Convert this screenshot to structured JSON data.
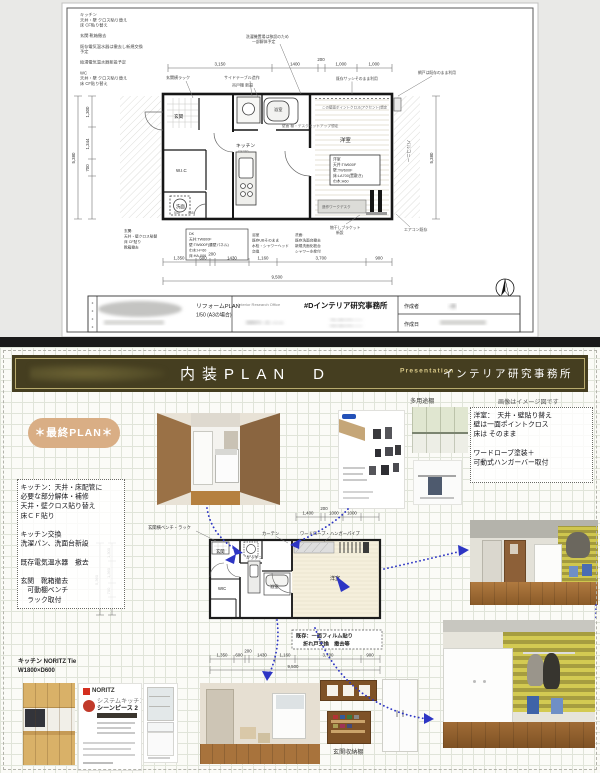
{
  "colors": {
    "banner_olive": "#453e20",
    "badge_tan": "#d9ae85",
    "arrow_blue": "#2d35c4",
    "gold_line": "#cdbe7d"
  },
  "top_sheet": {
    "notes_left": [
      "キッチン",
      "天井・壁 クロス貼り替え",
      "床 CF貼り替え",
      "",
      "玄関 靴箱撤去",
      "",
      "既存電気温水器は撤去し新規交換",
      "予定",
      "",
      "給湯電気温水器新設予定",
      "",
      "WC",
      "天井・壁 クロス貼り替え",
      "床 CF貼り替え"
    ],
    "leaders": {
      "rack": "玄関横ラック",
      "side_table": "サイドテーブル造作",
      "hang_shelf": "吊戸棚 新設",
      "top_note1": "洗濯機置場は移設のため",
      "top_note2": "一部解体予定",
      "sash": "既存サッシそのまま利用",
      "amido": "網戸は既存のまま利用",
      "accent": "この壁面ポイントクロス(アクセント)想定",
      "desk_note": "壁面 棚・デスクセットアップ想定",
      "aircon": "エアコン既存",
      "bracket1": "物干しブラケット",
      "bracket2": "新設",
      "work_desk": "造作ワークデスク"
    },
    "rooms": {
      "entrance": "玄関",
      "wic": "W.I.C",
      "wash": "洗面",
      "kitchen": "キッチン",
      "kitchen_sub": "CK240",
      "bath": "浴室",
      "room": "洋室",
      "balcony": "バルコニー"
    },
    "room_box": [
      "洋室",
      "天井:TW600F",
      "壁:TW600F",
      "床:LA700(置敷き)",
      "巾木:H60"
    ],
    "dk_box": [
      "DK",
      "天井:TW600F",
      "壁:TW600F(腰壁パネル)",
      "巾木:H=60",
      "床:HA-006"
    ],
    "bath_note": [
      "浴室",
      "既存UBそのまま",
      "水栓・シャワーヘッド",
      "交換"
    ],
    "wash_note": [
      "洗面:",
      "既存洗面台撤去",
      "新規洗面化粧台",
      "シャワー水栓付"
    ],
    "entry_note": [
      "玄関:",
      "天井・壁クロス貼替",
      "床 CF貼り",
      "靴箱撤去"
    ],
    "dims_top": [
      "3,150",
      "1400",
      "200",
      "1,000",
      "1,000"
    ],
    "dims_bottom": [
      "1,350",
      "600",
      "200",
      "1430",
      "1,160",
      "3,700",
      "900"
    ],
    "dim_total": "9,500",
    "dims_left": [
      "1,300",
      "1,344",
      "700"
    ],
    "dim_left_total": "5,380",
    "dim_right": "5,380",
    "small_dims": [
      "545",
      "565"
    ],
    "title_block": {
      "doc_title": "リフォームPLAN",
      "scale": "1/50 (A3の場合)",
      "office_en": "Interior Research Office",
      "office": "#Dインテリア研究事務所",
      "address": "相模原市○○区○○3-1-8",
      "tel": "TEL.050-474-○○○○",
      "fax": "FAX.050-474-○○○○",
      "creator_label": "作成者",
      "creator": "○田",
      "date_label": "作成日"
    }
  },
  "bottom_sheet": {
    "header": {
      "title": "内装PLAN　D",
      "tag": "Presentation",
      "office": "インテリア研究事務所"
    },
    "note_image": "画像はイメージ図です",
    "badge": "＊最終PLAN＊",
    "work_list": [
      "キッチン：天井・床配管に",
      "必要な部分解体・補修",
      "天井・壁クロス貼り替え",
      "床ＣＦ貼り",
      "",
      "キッチン交換",
      "洗濯パン、洗面台新設",
      "",
      "既存電気温水器　撤去",
      "",
      "玄関　靴箱撤去",
      "　可動棚ベンチ",
      "　ラック取付"
    ],
    "room_note": [
      "洋室：　天井・壁貼り替え",
      "壁は一面ポイントクロス",
      "床は そのまま",
      "",
      "ワードローブ塗装＋",
      "可動式ハンガーバー取付"
    ],
    "kitchen_note1": "キッチン NORITZ Tie",
    "kitchen_note2": "W1800×D600",
    "existing_note1": "既存：一面フィルム貼り",
    "existing_note2": "折れ戸交換　撤去等",
    "leaders": {
      "bench": "玄関横ベンチ・ラック",
      "curtain": "カーテン",
      "wardrobe": "ワードローブ・ハンガーパイプ"
    },
    "rooms": {
      "entrance": "玄関",
      "wic": "WIC",
      "kitchen": "キッチン",
      "bath": "浴室",
      "room": "洋室"
    },
    "dims_top": [
      "1,400",
      "200",
      "1000",
      "1000"
    ],
    "dims_bottom": [
      "1,350",
      "600",
      "200",
      "1430",
      "1,160",
      "3,700",
      "900"
    ],
    "dim_total": "9,500",
    "dims_left": [
      "1,300",
      "1,360",
      "700"
    ],
    "dim_left_total": "5,360",
    "labels": {
      "catalog_shelf": "多用途棚",
      "shoe_shelf": "玄関収納棚"
    },
    "catalog": {
      "brand": "NORITZ",
      "series": "シーンピース 2",
      "series_tag": "システムキッチン"
    }
  }
}
